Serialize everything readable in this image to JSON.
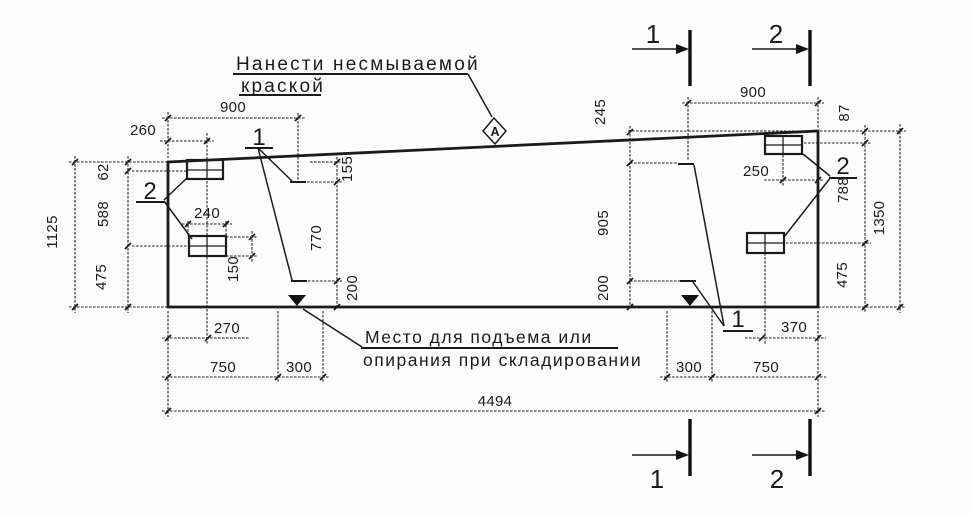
{
  "drawing": {
    "notes": {
      "paint_line1": "Нанести несмываемой",
      "paint_line2": "краской",
      "storage_line1": "Место для подъема или",
      "storage_line2": "опирания при складировании"
    },
    "surface_mark": "А",
    "sections": {
      "s1": "1",
      "s2": "2"
    },
    "callouts": {
      "c1": "1",
      "c2": "2"
    },
    "dims": {
      "d900l": "900",
      "d260": "260",
      "d900r": "900",
      "d1125": "1125",
      "d62": "62",
      "d588": "588",
      "d475l": "475",
      "d155": "155",
      "d770": "770",
      "d200l": "200",
      "d240": "240",
      "d150": "150",
      "d245": "245",
      "d905": "905",
      "d200r": "200",
      "d250": "250",
      "d87": "87",
      "d788": "788",
      "d1350": "1350",
      "d475r": "475",
      "d270": "270",
      "d750l": "750",
      "d300l": "300",
      "d300r": "300",
      "d750r": "750",
      "d370": "370",
      "d4494": "4494"
    }
  }
}
